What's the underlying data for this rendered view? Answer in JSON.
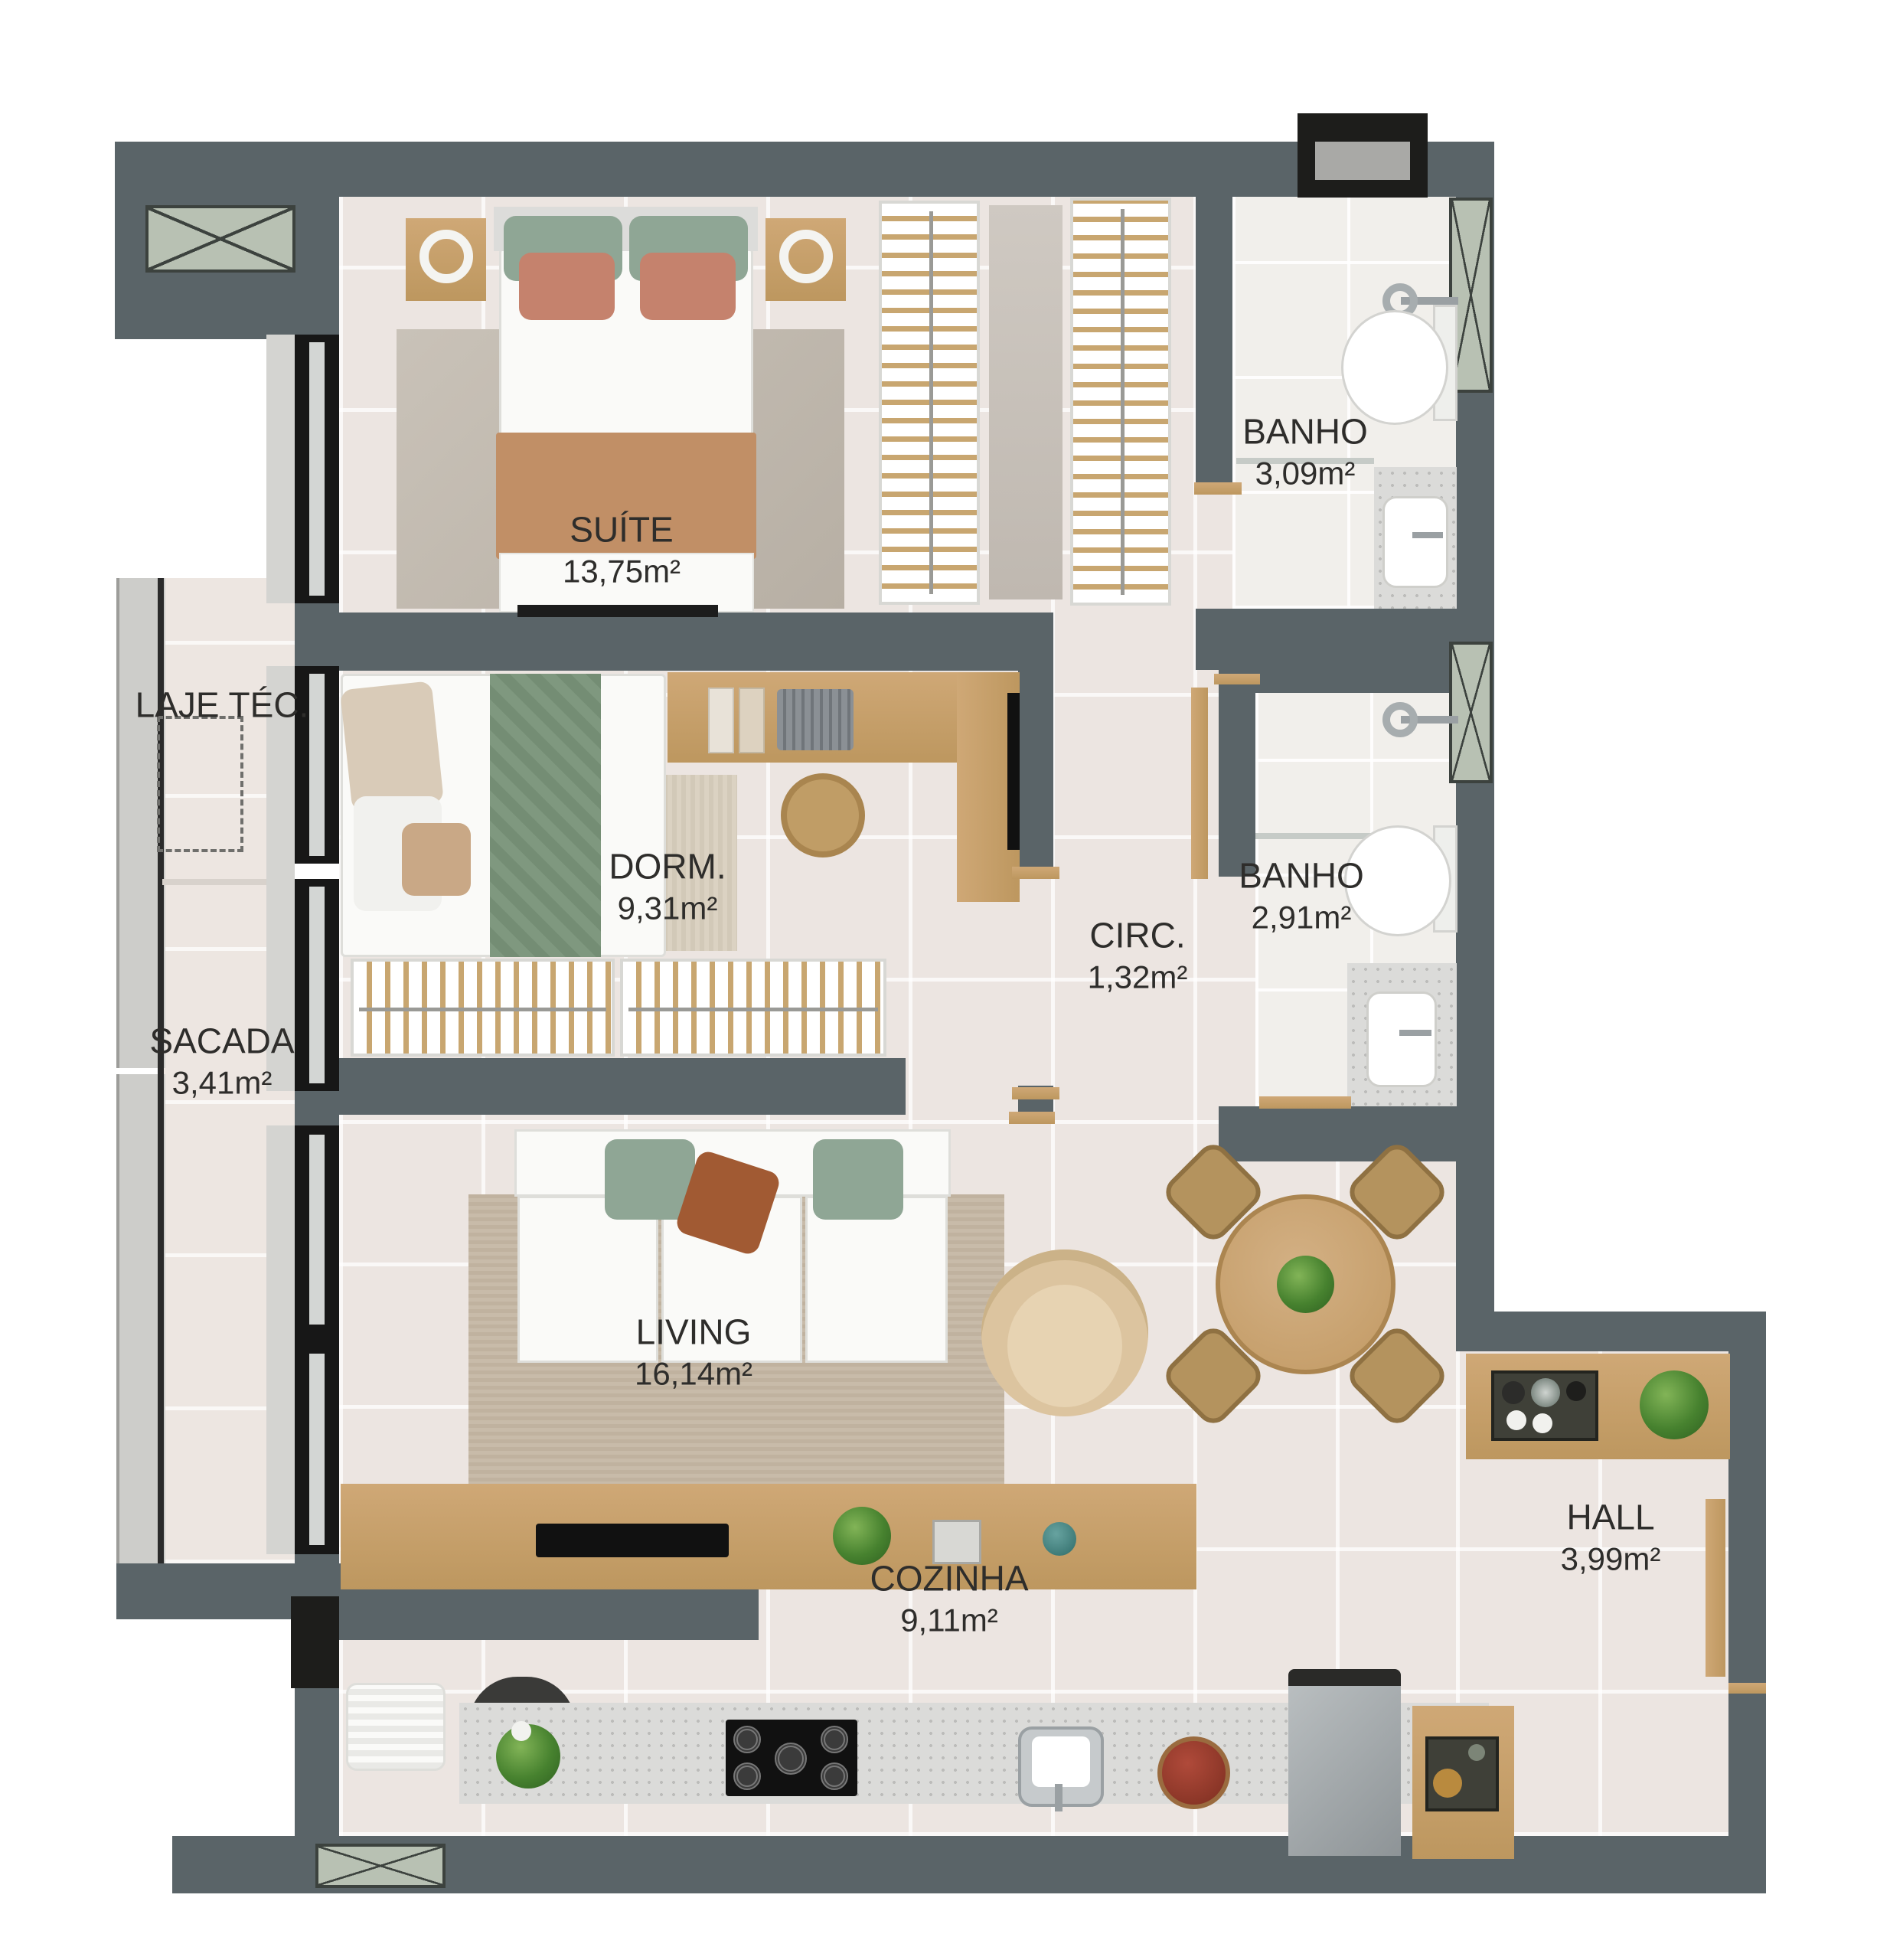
{
  "rooms": {
    "suite": {
      "name": "SUÍTE",
      "area": "13,75m²"
    },
    "dorm": {
      "name": "DORM.",
      "area": "9,31m²"
    },
    "banho_suite": {
      "name": "BANHO",
      "area": "3,09m²"
    },
    "banho_social": {
      "name": "BANHO",
      "area": "2,91m²"
    },
    "circ": {
      "name": "CIRC.",
      "area": "1,32m²"
    },
    "sacada": {
      "name": "SACADA",
      "area": "3,41m²"
    },
    "laje": {
      "name": "LAJE TÉC.",
      "area": ""
    },
    "living": {
      "name": "LIVING",
      "area": "16,14m²"
    },
    "cozinha": {
      "name": "COZINHA",
      "area": "9,11m²"
    },
    "hall": {
      "name": "HALL",
      "area": "3,99m²"
    }
  },
  "colors": {
    "wall": "#5a6468",
    "floor": "#ece5e1",
    "bath_floor": "#f1efeb",
    "wood": "#c7a06c",
    "window_frame": "#171717",
    "hatch_window": "#b8c1b3",
    "granite": "#dbdbd9",
    "pillow_green": "#8fa695",
    "pillow_salmon": "#c5826d",
    "pillow_rust": "#a15a33",
    "blanket_tan": "#c18f66",
    "plant_green": "#47822f",
    "label_text": "#2e2d2b"
  }
}
